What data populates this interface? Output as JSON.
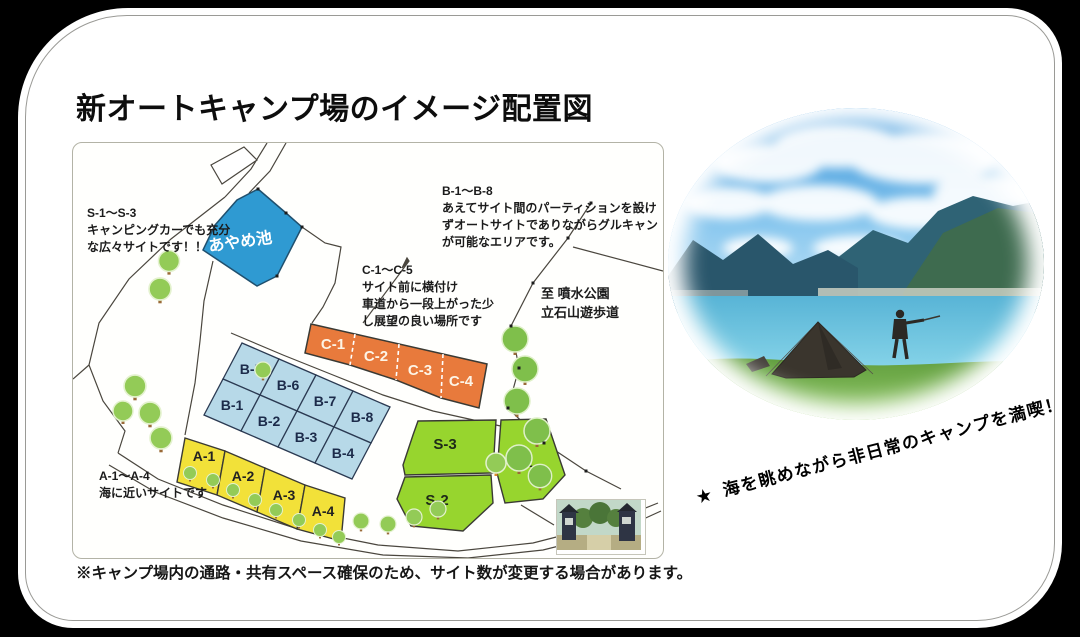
{
  "title": "新オートキャンプ場のイメージ配置図",
  "footnote": "※キャンプ場内の通路・共有スペース確保のため、サイト数が変更する場合があります。",
  "colors": {
    "pond": "#2f9ad2",
    "site_a": "#f2e139",
    "site_b": "#b7d9e8",
    "site_c": "#e87a3c",
    "site_s": "#97d52e",
    "card_bg": "#ffffff",
    "page_bg": "#000000"
  },
  "map": {
    "pond_label": "あやめ池",
    "notes": {
      "s": {
        "lines": [
          "S-1～S-3",
          "キャンピングカーでも充分",
          "な広々サイトです！！"
        ]
      },
      "b": {
        "lines": [
          "B-1～B-8",
          "あえてサイト間のパーティションを設け",
          "ずオートサイトでありながらグルキャン",
          "が可能なエリアです。"
        ]
      },
      "c": {
        "lines": [
          "C-1～C-5",
          "サイト前に横付け",
          "車道から一段上がった少",
          "し展望の良い場所です"
        ]
      },
      "fountain": {
        "lines": [
          "至 噴水公園",
          "立石山遊歩道"
        ]
      },
      "a": {
        "lines": [
          "A-1～A-4",
          "海に近いサイトです"
        ]
      }
    },
    "sites": {
      "a": {
        "labels": [
          "A-1",
          "A-2",
          "A-3",
          "A-4"
        ]
      },
      "b": {
        "labels": [
          "B-5",
          "B-6",
          "B-7",
          "B-8",
          "B-1",
          "B-2",
          "B-3",
          "B-4"
        ]
      },
      "c": {
        "labels": [
          "C-1",
          "C-2",
          "C-3",
          "C-4"
        ]
      },
      "s": {
        "labels": [
          "S-3",
          "S-1",
          "S-2"
        ]
      }
    }
  },
  "slogan": {
    "star": "★",
    "text": "海を眺めながら非日常のキャンプを満喫！"
  }
}
